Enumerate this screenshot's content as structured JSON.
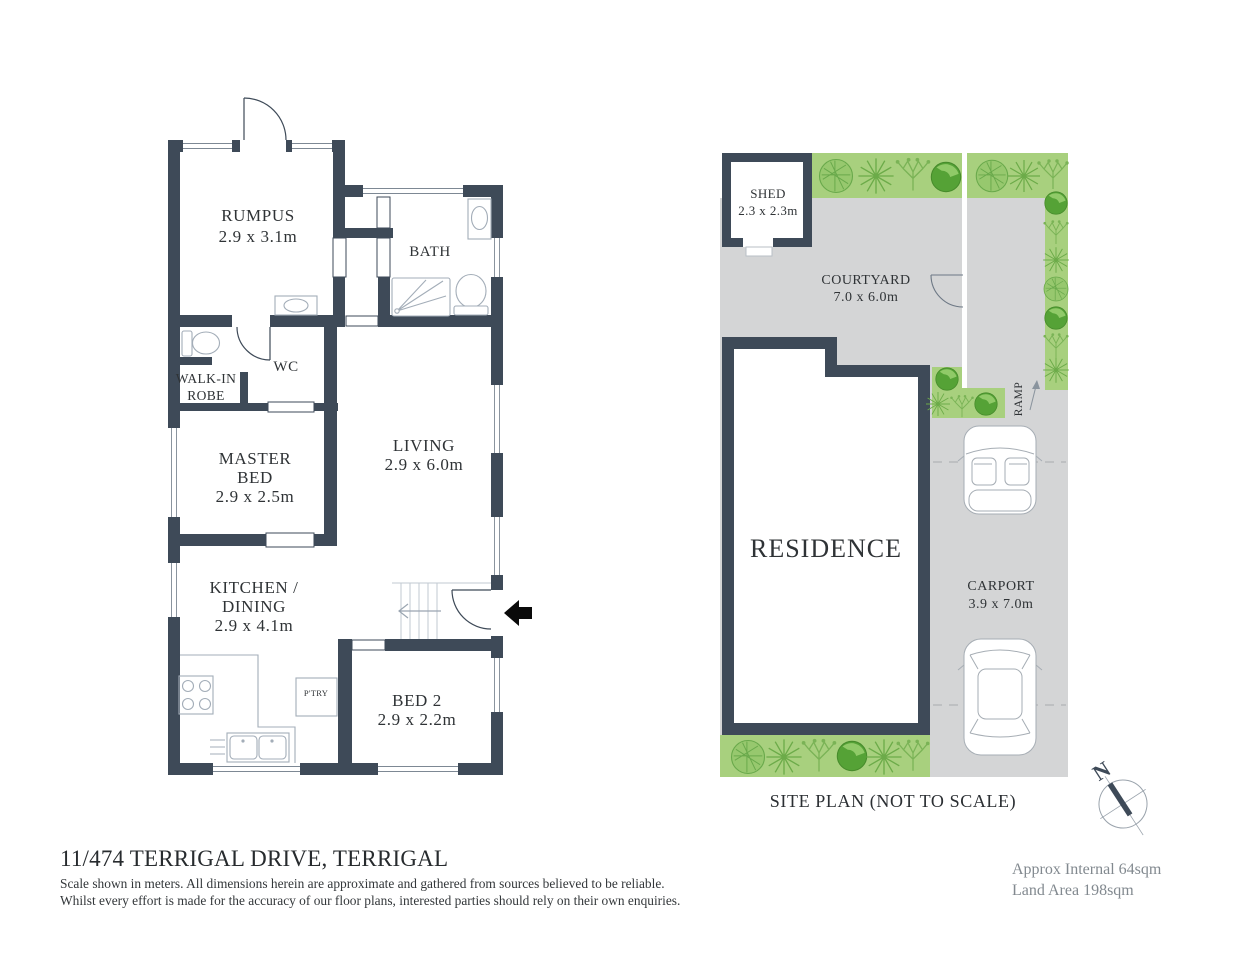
{
  "floor_plan": {
    "rumpus": {
      "name": "RUMPUS",
      "dims": "2.9 x 3.1m"
    },
    "bath": {
      "name": "BATH"
    },
    "wc": {
      "name": "WC"
    },
    "robe": {
      "line1": "WALK-IN",
      "line2": "ROBE"
    },
    "master": {
      "line1": "MASTER",
      "line2": "BED",
      "dims": "2.9 x 2.5m"
    },
    "living": {
      "name": "LIVING",
      "dims": "2.9 x 6.0m"
    },
    "kitchen": {
      "line1": "KITCHEN /",
      "line2": "DINING",
      "dims": "2.9 x 4.1m"
    },
    "pantry": {
      "name": "P'TRY"
    },
    "bed2": {
      "name": "BED 2",
      "dims": "2.9 x 2.2m"
    }
  },
  "site_plan": {
    "shed": {
      "name": "SHED",
      "dims": "2.3 x 2.3m"
    },
    "courtyard": {
      "name": "COURTYARD",
      "dims": "7.0 x 6.0m"
    },
    "residence": {
      "name": "RESIDENCE"
    },
    "ramp": {
      "name": "RAMP"
    },
    "carport": {
      "name": "CARPORT",
      "dims": "3.9 x 7.0m"
    },
    "caption": "SITE PLAN (NOT TO SCALE)",
    "compass_n": "N"
  },
  "footer": {
    "address": "11/474 TERRIGAL DRIVE, TERRIGAL",
    "disclaimer_line1": "Scale shown in meters. All dimensions herein are approximate and gathered from sources believed to be  reliable.",
    "disclaimer_line2": "Whilst every effort is made for the accuracy of our floor plans, interested parties should rely on their own enquiries.",
    "approx_internal": "Approx Internal 64sqm",
    "land_area": "Land Area 198sqm"
  },
  "colors": {
    "wall": "#3e4a58",
    "paving_gray": "#d4d5d6",
    "garden_green": "#a8d07e",
    "bush_green": "#55a236"
  }
}
